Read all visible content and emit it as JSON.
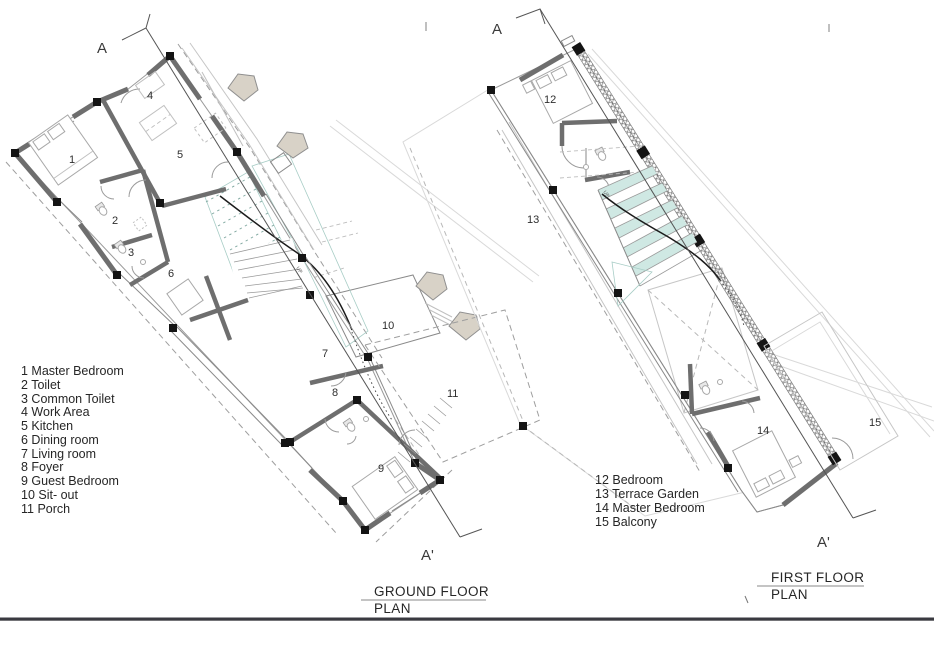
{
  "ground_plan": {
    "title_line1": "GROUND FLOOR",
    "title_line2": "PLAN",
    "section_start": "A",
    "section_end": "A'",
    "up_label": "UP",
    "room_numbers": [
      "1",
      "2",
      "3",
      "4",
      "5",
      "6",
      "7",
      "8",
      "9",
      "10",
      "11"
    ],
    "legend": [
      "1 Master Bedroom",
      "2 Toilet",
      "3 Common Toilet",
      "4 Work Area",
      "5 Kitchen",
      "6 Dining room",
      "7 Living room",
      "8 Foyer",
      "9 Guest Bedroom",
      "10 Sit- out",
      "11 Porch"
    ]
  },
  "first_plan": {
    "title_line1": "FIRST FLOOR",
    "title_line2": "PLAN",
    "section_start": "A",
    "section_end": "A'",
    "up_label": "UP",
    "room_numbers": [
      "12",
      "13",
      "14",
      "15"
    ],
    "legend": [
      "12 Bedroom",
      "13 Terrace Garden",
      "14 Master Bedroom",
      "15 Balcony"
    ]
  },
  "colors": {
    "wall": "#6e6e6e",
    "column": "#141414",
    "water": "#cfe8e3",
    "bay_window": "#d8d2c7",
    "divider": "#3a3a40",
    "text": "#262626"
  }
}
